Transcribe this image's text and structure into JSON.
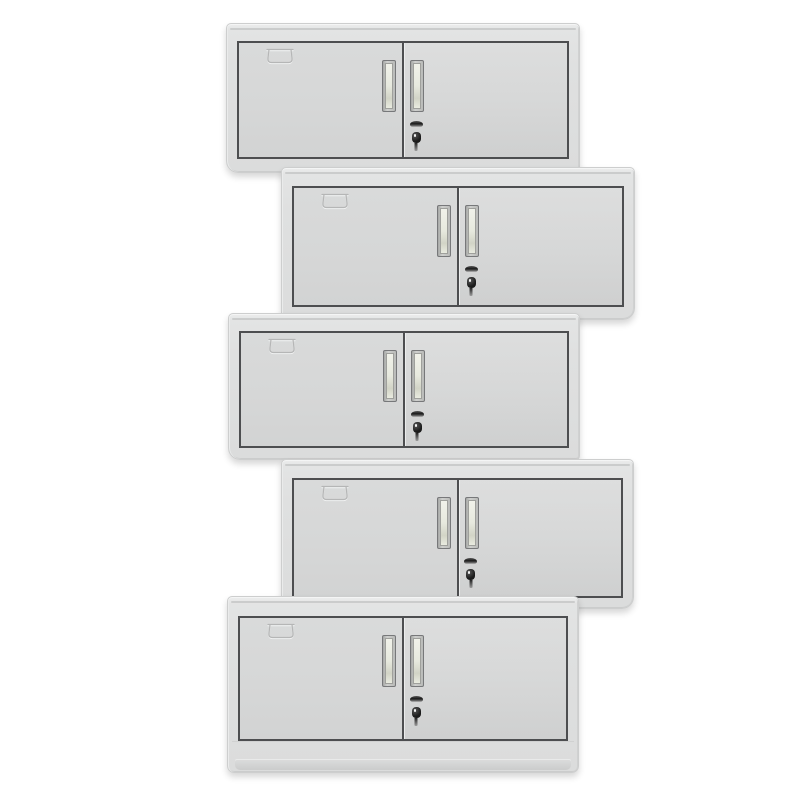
{
  "scene": {
    "description": "Product photo: five identical light-grey two-door steel wall cabinets stacked vertically in an alternating left-right zigzag arrangement on a plain white background",
    "background_color": "#ffffff"
  },
  "colors": {
    "background": "#ffffff",
    "frame": "#dfe0e0",
    "frame_edge": "#c2c3c3",
    "frame_outline": "#cdcece",
    "door": "#d6d7d7",
    "door_border": "#4d4e50",
    "handle_bezel_a": "#cfd0ce",
    "handle_bezel_b": "#a6a7a5",
    "handle_border": "#77787a",
    "handle_recess_a": "#f1f2ea",
    "handle_recess_b": "#d2d4c6",
    "lock_dark": "#1b1b1b",
    "lock_metal": "#dadada",
    "emboss": "#b5b6b6",
    "emboss_light": "#f0f1f1",
    "shadow": "rgba(0,0,0,0.16)"
  },
  "icons": {
    "label_card_slot": "embossed label-card holder outline on upper-left of left door",
    "door_handle": "recessed vertical pull handle, one per door beside the centre gap",
    "lock": "cam-lock cylinder on right door with key hanging from keyhole"
  },
  "cabinets": [
    {
      "name": "cabinet-1",
      "left": 226,
      "top": 23,
      "width": 354,
      "height": 150,
      "door_top": 17,
      "door_height": 118,
      "align": "left",
      "base": false
    },
    {
      "name": "cabinet-2",
      "left": 281,
      "top": 167,
      "width": 354,
      "height": 153,
      "door_top": 18,
      "door_height": 121,
      "align": "right",
      "base": false
    },
    {
      "name": "cabinet-3",
      "left": 228,
      "top": 313,
      "width": 352,
      "height": 147,
      "door_top": 17,
      "door_height": 117,
      "align": "left",
      "base": false
    },
    {
      "name": "cabinet-4",
      "left": 281,
      "top": 459,
      "width": 353,
      "height": 150,
      "door_top": 18,
      "door_height": 120,
      "align": "right",
      "base": false
    },
    {
      "name": "cabinet-5",
      "left": 227,
      "top": 596,
      "width": 352,
      "height": 177,
      "door_top": 19,
      "door_height": 125,
      "align": "left",
      "base": true
    }
  ]
}
